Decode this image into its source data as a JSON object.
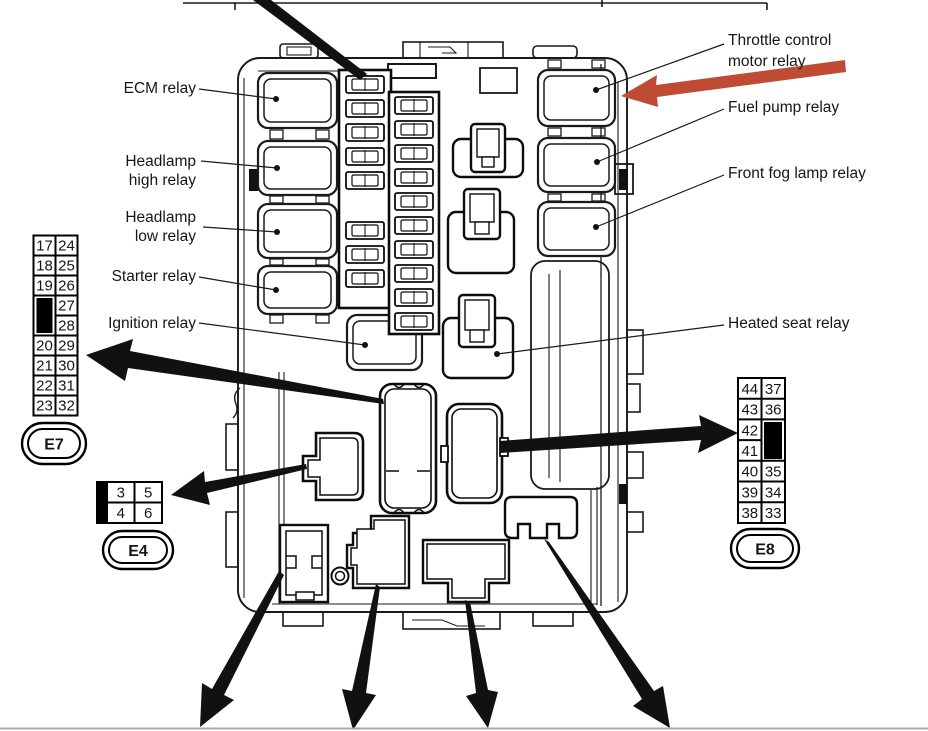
{
  "diagram_title": "Engine room fuse / relay box diagram",
  "labels": {
    "ecm": "ECM relay",
    "headlamp_high": [
      "Headlamp",
      "high relay"
    ],
    "headlamp_low": [
      "Headlamp",
      "low relay"
    ],
    "starter": "Starter relay",
    "ignition": "Ignition relay",
    "throttle": [
      "Throttle control",
      "motor relay"
    ],
    "fuel_pump": "Fuel pump relay",
    "front_fog": "Front fog lamp relay",
    "heated_seat": "Heated seat relay"
  },
  "tables": {
    "e7": {
      "id": "E7",
      "rows": [
        [
          "17",
          "24"
        ],
        [
          "18",
          "25"
        ],
        [
          "19",
          "26"
        ],
        [
          "",
          "27"
        ],
        [
          "",
          "28"
        ],
        [
          "20",
          "29"
        ],
        [
          "21",
          "30"
        ],
        [
          "22",
          "31"
        ],
        [
          "23",
          "32"
        ]
      ],
      "blocked_cell": {
        "column": "left",
        "rows_spanned": "27-28 rows (black key)"
      }
    },
    "e4": {
      "id": "E4",
      "rows": [
        [
          "3",
          "5"
        ],
        [
          "4",
          "6"
        ]
      ],
      "blocked_cell": {
        "column": "left-bar",
        "rows_spanned": "full height (black key)"
      }
    },
    "e8": {
      "id": "E8",
      "rows": [
        [
          "44",
          "37"
        ],
        [
          "43",
          "36"
        ],
        [
          "42",
          ""
        ],
        [
          "41",
          ""
        ],
        [
          "40",
          "35"
        ],
        [
          "39",
          "34"
        ],
        [
          "38",
          "33"
        ]
      ],
      "blocked_cell": {
        "column": "right",
        "rows_spanned": "42-41 rows (black key)"
      }
    }
  },
  "colors": {
    "line": "#1a1a1a",
    "arrow_black": "#111111",
    "arrow_red": "#c04b35",
    "page_background": "#ffffff",
    "bottom_rule": "#a9a9a9"
  }
}
